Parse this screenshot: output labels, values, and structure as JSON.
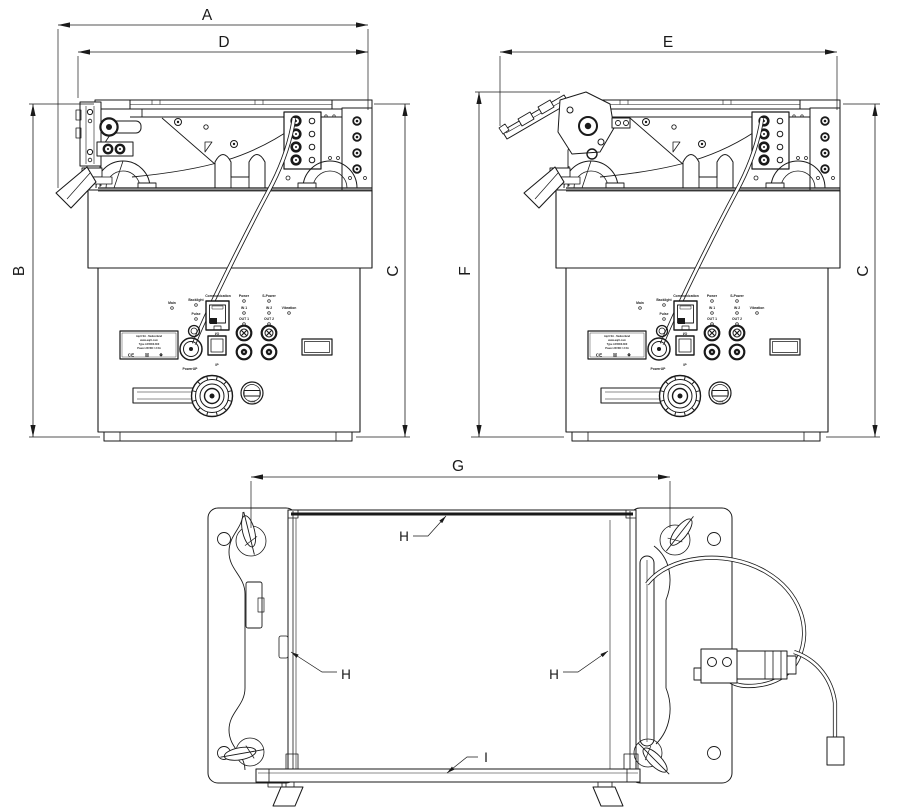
{
  "drawing": {
    "type": "technical dimensional drawing, three views of a ticket-printer unit",
    "colors": {
      "line": "#1a1a1a",
      "background": "#ffffff"
    },
    "dimensions": {
      "A": "A",
      "B": "B",
      "C": "C",
      "D": "D",
      "E": "E",
      "F": "F",
      "G": "G"
    },
    "callouts": {
      "H": "H",
      "I": "I"
    },
    "panel": {
      "sticker": {
        "lines": [
          "Aqrit SA - Switzerland",
          "www.aqrit.com",
          "Type AC5000-300",
          "Power 24VDC / 2.5A"
        ],
        "marks": {
          "ce": "CE",
          "weee": "☒",
          "cert": "❖"
        }
      },
      "labels": {
        "main": "Main",
        "backlight": "Backlight",
        "pulse": "Pulse",
        "communication": "Communication",
        "power": "Power",
        "s_power": "S-Power",
        "in1": "IN 1",
        "in2": "IN 2",
        "out1": "OUT 1",
        "out2": "OUT 2",
        "vibration": "Vibration",
        "power_up": "PowerUP",
        "aux_top": "I/O",
        "aux_bottom": "IP",
        "fuse": "FUSE"
      }
    }
  }
}
